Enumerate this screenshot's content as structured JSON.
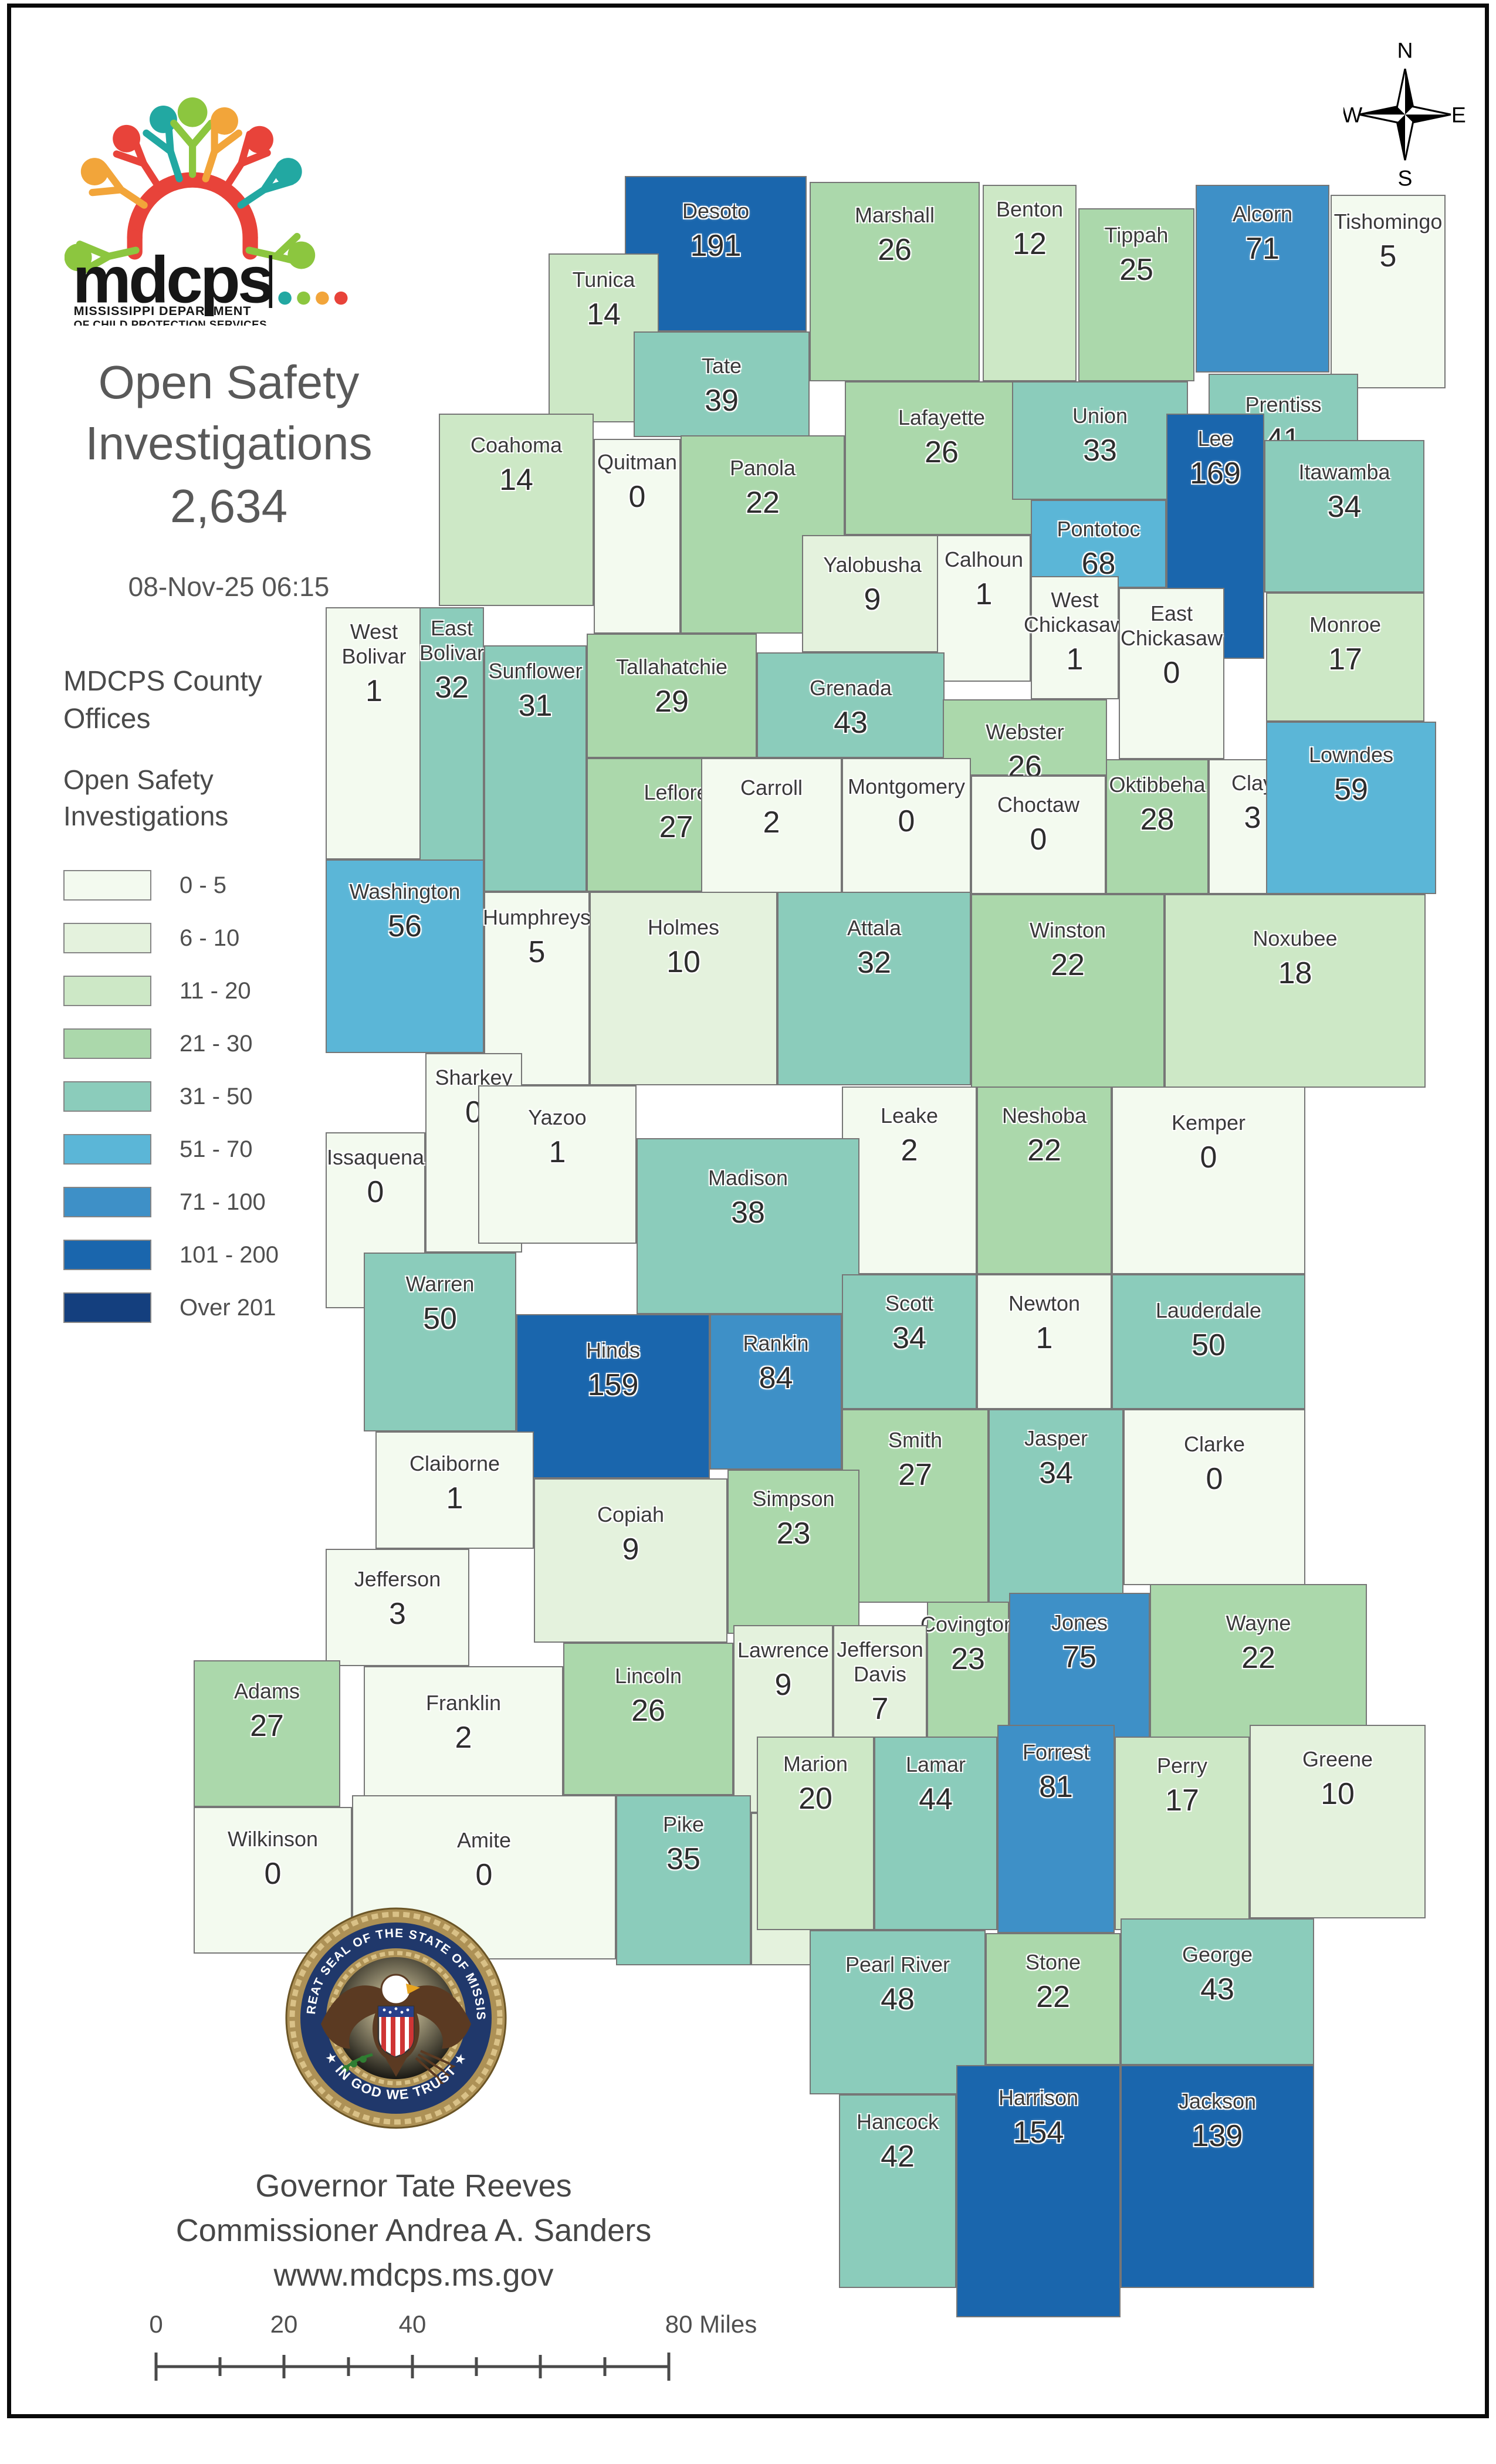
{
  "logo": {
    "acronym": "mdcps",
    "dept_line1": "MISSISSIPPI DEPARTMENT",
    "dept_line2": "OF CHILD PROTECTION SERVICES"
  },
  "header": {
    "title_line1": "Open Safety",
    "title_line2": "Investigations",
    "total": "2,634",
    "timestamp": "08-Nov-25 06:15"
  },
  "legend": {
    "offices_title_line1": "MDCPS County",
    "offices_title_line2": "Offices",
    "subtitle_line1": "Open Safety",
    "subtitle_line2": "Investigations",
    "classes": [
      {
        "label": "0 - 5",
        "color": "#f3faef"
      },
      {
        "label": "6 - 10",
        "color": "#e4f2dd"
      },
      {
        "label": "11 - 20",
        "color": "#cde8c6"
      },
      {
        "label": "21 - 30",
        "color": "#abd8ab"
      },
      {
        "label": "31 - 50",
        "color": "#8bccbb"
      },
      {
        "label": "51 - 70",
        "color": "#5bb6d7"
      },
      {
        "label": "71 - 100",
        "color": "#3e90c7"
      },
      {
        "label": "101 - 200",
        "color": "#1a66ad"
      },
      {
        "label": "Over 201",
        "color": "#143f7e"
      }
    ],
    "bucket_upper_bounds": [
      5,
      10,
      20,
      30,
      50,
      70,
      100,
      200
    ]
  },
  "compass": {
    "north": "N",
    "south": "S",
    "east": "E",
    "west": "W"
  },
  "seal": {
    "ring_text_top": "THE GREAT SEAL OF THE STATE OF MISSISSIPPI",
    "ring_text_bottom": "★ IN GOD WE TRUST ★"
  },
  "footer": {
    "governor": "Governor Tate Reeves",
    "commissioner": "Commissioner Andrea A. Sanders",
    "website": "www.mdcps.ms.gov"
  },
  "scale_bar": {
    "labels": [
      "0",
      "20",
      "40",
      "80 Miles"
    ]
  },
  "map": {
    "counties": [
      {
        "name": "Desoto",
        "value": 191
      },
      {
        "name": "Marshall",
        "value": 26
      },
      {
        "name": "Benton",
        "value": 12
      },
      {
        "name": "Tippah",
        "value": 25
      },
      {
        "name": "Alcorn",
        "value": 71
      },
      {
        "name": "Tishomingo",
        "value": 5
      },
      {
        "name": "Tunica",
        "value": 14
      },
      {
        "name": "Tate",
        "value": 39
      },
      {
        "name": "Lafayette",
        "value": 26
      },
      {
        "name": "Union",
        "value": 33
      },
      {
        "name": "Prentiss",
        "value": 41
      },
      {
        "name": "Lee",
        "value": 169
      },
      {
        "name": "Itawamba",
        "value": 34
      },
      {
        "name": "Coahoma",
        "value": 14
      },
      {
        "name": "Quitman",
        "value": 0
      },
      {
        "name": "Panola",
        "value": 22
      },
      {
        "name": "Pontotoc",
        "value": 68
      },
      {
        "name": "Yalobusha",
        "value": 9
      },
      {
        "name": "Calhoun",
        "value": 1
      },
      {
        "name": "West Chickasaw",
        "value": 1
      },
      {
        "name": "East Chickasaw",
        "value": 0
      },
      {
        "name": "Monroe",
        "value": 17
      },
      {
        "name": "West Bolivar",
        "value": 1
      },
      {
        "name": "East Bolivar",
        "value": 32
      },
      {
        "name": "Sunflower",
        "value": 31
      },
      {
        "name": "Tallahatchie",
        "value": 29
      },
      {
        "name": "Grenada",
        "value": 43
      },
      {
        "name": "Webster",
        "value": 26
      },
      {
        "name": "Oktibbeha",
        "value": 28
      },
      {
        "name": "Clay",
        "value": 3
      },
      {
        "name": "Lowndes",
        "value": 59
      },
      {
        "name": "Leflore",
        "value": 27
      },
      {
        "name": "Carroll",
        "value": 2
      },
      {
        "name": "Montgomery",
        "value": 0
      },
      {
        "name": "Choctaw",
        "value": 0
      },
      {
        "name": "Washington",
        "value": 56
      },
      {
        "name": "Humphreys",
        "value": 5
      },
      {
        "name": "Holmes",
        "value": 10
      },
      {
        "name": "Attala",
        "value": 32
      },
      {
        "name": "Winston",
        "value": 22
      },
      {
        "name": "Noxubee",
        "value": 18
      },
      {
        "name": "Sharkey",
        "value": 0
      },
      {
        "name": "Yazoo",
        "value": 1
      },
      {
        "name": "Leake",
        "value": 2
      },
      {
        "name": "Neshoba",
        "value": 22
      },
      {
        "name": "Kemper",
        "value": 0
      },
      {
        "name": "Issaquena",
        "value": 0
      },
      {
        "name": "Madison",
        "value": 38
      },
      {
        "name": "Warren",
        "value": 50
      },
      {
        "name": "Scott",
        "value": 34
      },
      {
        "name": "Newton",
        "value": 1
      },
      {
        "name": "Lauderdale",
        "value": 50
      },
      {
        "name": "Hinds",
        "value": 159
      },
      {
        "name": "Rankin",
        "value": 84
      },
      {
        "name": "Claiborne",
        "value": 1
      },
      {
        "name": "Smith",
        "value": 27
      },
      {
        "name": "Jasper",
        "value": 34
      },
      {
        "name": "Clarke",
        "value": 0
      },
      {
        "name": "Copiah",
        "value": 9
      },
      {
        "name": "Simpson",
        "value": 23
      },
      {
        "name": "Jefferson",
        "value": 3
      },
      {
        "name": "Covington",
        "value": 23
      },
      {
        "name": "Jones",
        "value": 75
      },
      {
        "name": "Wayne",
        "value": 22
      },
      {
        "name": "Adams",
        "value": 27
      },
      {
        "name": "Franklin",
        "value": 2
      },
      {
        "name": "Lincoln",
        "value": 26
      },
      {
        "name": "Lawrence",
        "value": 9
      },
      {
        "name": "Jefferson Davis",
        "value": 7
      },
      {
        "name": "Wilkinson",
        "value": 0
      },
      {
        "name": "Amite",
        "value": 0
      },
      {
        "name": "Pike",
        "value": 35
      },
      {
        "name": "Walthall",
        "value": 8
      },
      {
        "name": "Marion",
        "value": 20
      },
      {
        "name": "Lamar",
        "value": 44
      },
      {
        "name": "Forrest",
        "value": 81
      },
      {
        "name": "Perry",
        "value": 17
      },
      {
        "name": "Greene",
        "value": 10
      },
      {
        "name": "Pearl River",
        "value": 48
      },
      {
        "name": "Stone",
        "value": 22
      },
      {
        "name": "George",
        "value": 43
      },
      {
        "name": "Hancock",
        "value": 42
      },
      {
        "name": "Harrison",
        "value": 154
      },
      {
        "name": "Jackson",
        "value": 139
      }
    ]
  }
}
